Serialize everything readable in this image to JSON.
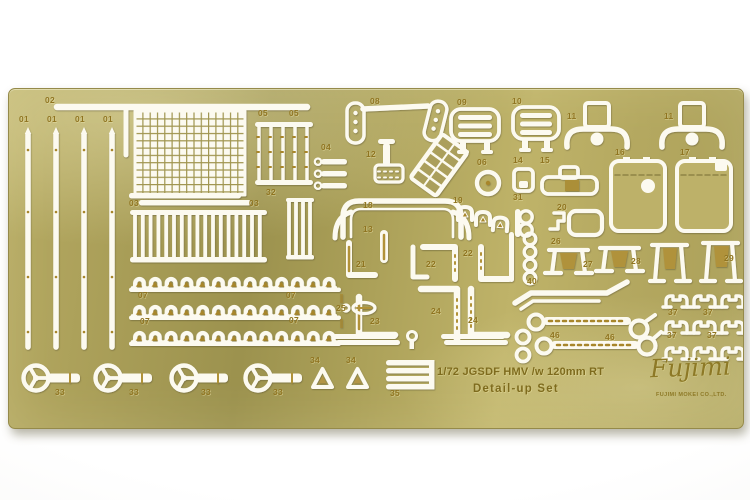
{
  "sheet_text": {
    "line1": "1/72 JGSDF HMV /w 120mm RT",
    "line2": "Detail-up Set",
    "logo": "Fujimi",
    "logo_sub": "FUJIMI MOKEI CO.,LTD."
  },
  "colors": {
    "brass_base": "#ab9f58",
    "brass_light": "#c2b66c",
    "brass_dark": "#9c924e",
    "etched_hole_white": "#fcfaf0",
    "label_gold": "#8f7420",
    "background": "#ffffff"
  },
  "part_labels": [
    {
      "n": "02",
      "x": 36,
      "y": 7
    },
    {
      "n": "01",
      "x": 10,
      "y": 26
    },
    {
      "n": "01",
      "x": 38,
      "y": 26
    },
    {
      "n": "01",
      "x": 66,
      "y": 26
    },
    {
      "n": "01",
      "x": 94,
      "y": 26
    },
    {
      "n": "05",
      "x": 249,
      "y": 20
    },
    {
      "n": "05",
      "x": 280,
      "y": 20
    },
    {
      "n": "08",
      "x": 361,
      "y": 8
    },
    {
      "n": "09",
      "x": 448,
      "y": 9
    },
    {
      "n": "10",
      "x": 503,
      "y": 8
    },
    {
      "n": "11",
      "x": 558,
      "y": 23
    },
    {
      "n": "11",
      "x": 655,
      "y": 23
    },
    {
      "n": "04",
      "x": 312,
      "y": 54
    },
    {
      "n": "12",
      "x": 357,
      "y": 61
    },
    {
      "n": "16",
      "x": 606,
      "y": 59
    },
    {
      "n": "17",
      "x": 671,
      "y": 59
    },
    {
      "n": "06",
      "x": 468,
      "y": 69
    },
    {
      "n": "14",
      "x": 504,
      "y": 67
    },
    {
      "n": "15",
      "x": 531,
      "y": 67
    },
    {
      "n": "32",
      "x": 257,
      "y": 99
    },
    {
      "n": "03",
      "x": 120,
      "y": 110
    },
    {
      "n": "03",
      "x": 240,
      "y": 110
    },
    {
      "n": "31",
      "x": 504,
      "y": 104
    },
    {
      "n": "19",
      "x": 444,
      "y": 107
    },
    {
      "n": "18",
      "x": 354,
      "y": 112
    },
    {
      "n": "20",
      "x": 548,
      "y": 114
    },
    {
      "n": "13",
      "x": 354,
      "y": 136
    },
    {
      "n": "26",
      "x": 542,
      "y": 148
    },
    {
      "n": "22",
      "x": 454,
      "y": 160
    },
    {
      "n": "21",
      "x": 347,
      "y": 171
    },
    {
      "n": "22",
      "x": 417,
      "y": 171
    },
    {
      "n": "27",
      "x": 574,
      "y": 171
    },
    {
      "n": "28",
      "x": 622,
      "y": 168
    },
    {
      "n": "29",
      "x": 715,
      "y": 165
    },
    {
      "n": "40",
      "x": 518,
      "y": 188
    },
    {
      "n": "07",
      "x": 129,
      "y": 202
    },
    {
      "n": "07",
      "x": 277,
      "y": 202
    },
    {
      "n": "25",
      "x": 327,
      "y": 215
    },
    {
      "n": "24",
      "x": 422,
      "y": 218
    },
    {
      "n": "37",
      "x": 659,
      "y": 219
    },
    {
      "n": "37",
      "x": 694,
      "y": 219
    },
    {
      "n": "23",
      "x": 361,
      "y": 228
    },
    {
      "n": "24",
      "x": 459,
      "y": 227
    },
    {
      "n": "07",
      "x": 131,
      "y": 228
    },
    {
      "n": "07",
      "x": 280,
      "y": 227
    },
    {
      "n": "46",
      "x": 541,
      "y": 242
    },
    {
      "n": "46",
      "x": 596,
      "y": 244
    },
    {
      "n": "37",
      "x": 658,
      "y": 242
    },
    {
      "n": "37",
      "x": 698,
      "y": 242
    },
    {
      "n": "34",
      "x": 301,
      "y": 267
    },
    {
      "n": "34",
      "x": 337,
      "y": 267
    },
    {
      "n": "33",
      "x": 46,
      "y": 299
    },
    {
      "n": "33",
      "x": 120,
      "y": 299
    },
    {
      "n": "33",
      "x": 192,
      "y": 299
    },
    {
      "n": "33",
      "x": 264,
      "y": 299
    },
    {
      "n": "35",
      "x": 381,
      "y": 300
    }
  ]
}
